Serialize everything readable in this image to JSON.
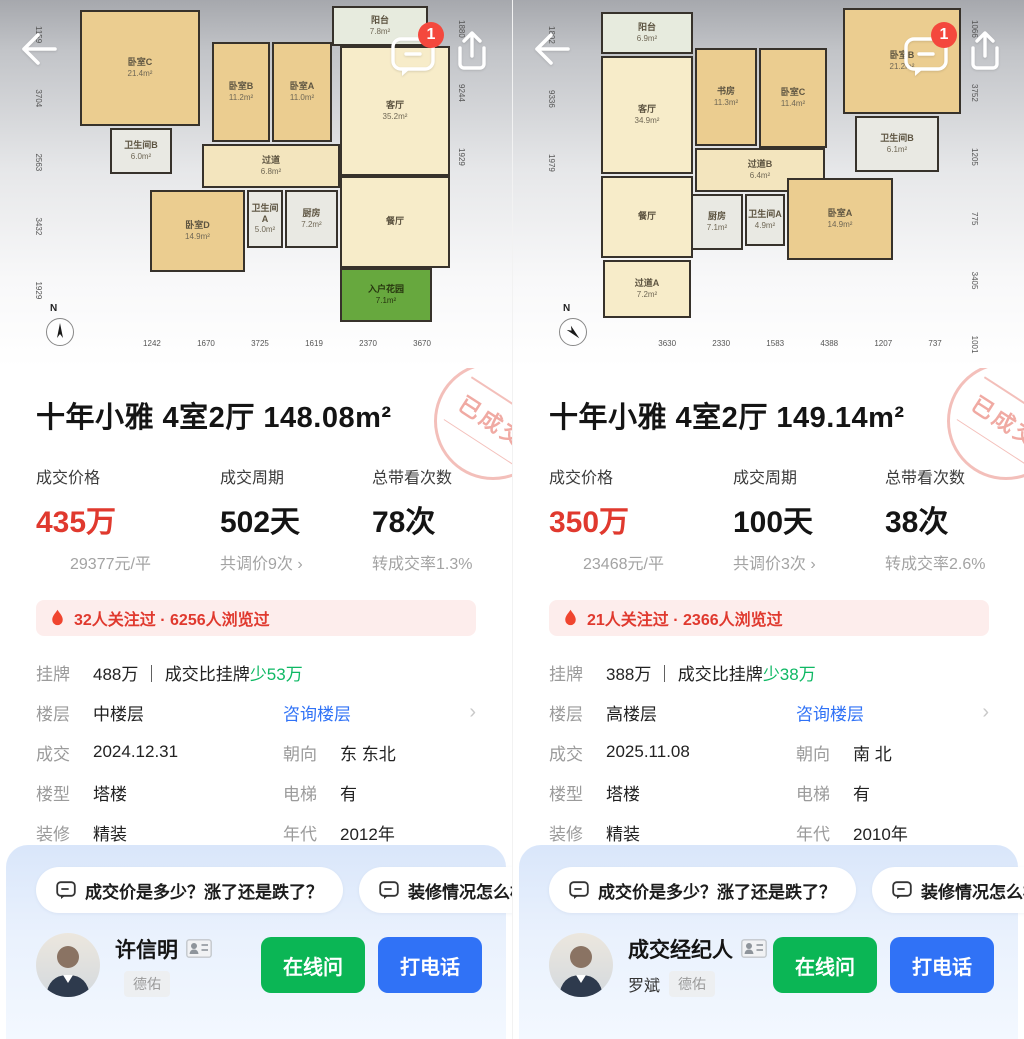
{
  "colors": {
    "accent_red": "#E0392E",
    "badge_red": "#F4483D",
    "link_blue": "#3072F6",
    "green_diff": "#0EB864",
    "btn_green": "#0BB655",
    "btn_blue": "#3072F6",
    "hot_bg": "#FDEDEC",
    "stamp": "#EE9C94",
    "stamp_ring": "#F2B5AF"
  },
  "panels": [
    {
      "header": {
        "badge_count": "1"
      },
      "floorplan": {
        "rooms": [
          {
            "name": "卧室C",
            "area": "21.4m²"
          },
          {
            "name": "卧室B",
            "area": "11.2m²"
          },
          {
            "name": "卧室A",
            "area": "11.0m²"
          },
          {
            "name": "阳台",
            "area": "7.8m²"
          },
          {
            "name": "卫生间B",
            "area": "6.0m²"
          },
          {
            "name": "过道",
            "area": "6.8m²"
          },
          {
            "name": "客厅",
            "area": "35.2m²"
          },
          {
            "name": "卧室D",
            "area": "14.9m²"
          },
          {
            "name": "卫生间A",
            "area": "5.0m²"
          },
          {
            "name": "厨房",
            "area": "7.2m²"
          },
          {
            "name": "餐厅",
            "area": ""
          },
          {
            "name": "入户花园",
            "area": "7.1m²"
          }
        ],
        "dims_bottom": "1242 1670 3725 1619 2370 3670",
        "dims_left": "1159 3704 2563 3432 1929",
        "dims_right": "1880 9244 1929",
        "compass_label": "N"
      },
      "stamp": "已成交",
      "title": "十年小雅 4室2厅 148.08m²",
      "stats": [
        {
          "label": "成交价格",
          "value": "435万",
          "sub": "29377元/平"
        },
        {
          "label": "成交周期",
          "value": "502天",
          "sub": "共调价9次 ›"
        },
        {
          "label": "总带看次数",
          "value": "78次",
          "sub": "转成交率1.3%"
        }
      ],
      "hot_bar": "32人关注过 · 6256人浏览过",
      "info": {
        "listing": {
          "label": "挂牌",
          "value": "488万 ｜ 成交比挂牌",
          "diff": "少53万"
        },
        "floor": {
          "label": "楼层",
          "value": "中楼层",
          "link": "咨询楼层",
          "chevron": "›"
        },
        "rows": [
          {
            "l1": "成交",
            "v1": "2024.12.31",
            "l2": "朝向",
            "v2": "东 东北"
          },
          {
            "l1": "楼型",
            "v1": "塔楼",
            "l2": "电梯",
            "v2": "有"
          },
          {
            "l1": "装修",
            "v1": "精装",
            "l2": "年代",
            "v2": "2012年"
          },
          {
            "l1": "用途",
            "v1": "普通住宅",
            "l2": "权属",
            "v2": "商品房"
          }
        ]
      },
      "chips": [
        "成交价是多少？涨了还是跌了？",
        "装修情况怎么样?"
      ],
      "agent": {
        "name": "许信明",
        "sub_name": "",
        "company": "德佑",
        "ask_label": "在线问",
        "call_label": "打电话"
      }
    },
    {
      "header": {
        "badge_count": "1"
      },
      "floorplan": {
        "rooms": [
          {
            "name": "阳台",
            "area": "6.9m²"
          },
          {
            "name": "客厅",
            "area": "34.9m²"
          },
          {
            "name": "书房",
            "area": "11.3m²"
          },
          {
            "name": "卧室C",
            "area": "11.4m²"
          },
          {
            "name": "卧室B",
            "area": "21.2m²"
          },
          {
            "name": "卫生间B",
            "area": "6.1m²"
          },
          {
            "name": "过道B",
            "area": "6.4m²"
          },
          {
            "name": "餐厅",
            "area": ""
          },
          {
            "name": "厨房",
            "area": "7.1m²"
          },
          {
            "name": "卫生间A",
            "area": "4.9m²"
          },
          {
            "name": "卧室A",
            "area": "14.9m²"
          },
          {
            "name": "过道A",
            "area": "7.2m²"
          }
        ],
        "dims_bottom": "3630 2330 1583 4388 1207 737",
        "dims_left": "1802 9336 1979",
        "dims_right": "1066 3752 1205 775 3405 1001 1979",
        "compass_label": "N"
      },
      "stamp": "已成交",
      "title": "十年小雅 4室2厅 149.14m²",
      "stats": [
        {
          "label": "成交价格",
          "value": "350万",
          "sub": "23468元/平"
        },
        {
          "label": "成交周期",
          "value": "100天",
          "sub": "共调价3次 ›"
        },
        {
          "label": "总带看次数",
          "value": "38次",
          "sub": "转成交率2.6%"
        }
      ],
      "hot_bar": "21人关注过 · 2366人浏览过",
      "info": {
        "listing": {
          "label": "挂牌",
          "value": "388万 ｜ 成交比挂牌",
          "diff": "少38万"
        },
        "floor": {
          "label": "楼层",
          "value": "高楼层",
          "link": "咨询楼层",
          "chevron": "›"
        },
        "rows": [
          {
            "l1": "成交",
            "v1": "2025.11.08",
            "l2": "朝向",
            "v2": "南 北"
          },
          {
            "l1": "楼型",
            "v1": "塔楼",
            "l2": "电梯",
            "v2": "有"
          },
          {
            "l1": "装修",
            "v1": "精装",
            "l2": "年代",
            "v2": "2010年"
          },
          {
            "l1": "用途",
            "v1": "普通住宅",
            "l2": "权属",
            "v2": "商品房"
          }
        ]
      },
      "chips": [
        "成交价是多少？涨了还是跌了？",
        "装修情况怎么样?"
      ],
      "agent": {
        "name": "成交经纪人",
        "sub_name": "罗斌",
        "company": "德佑",
        "ask_label": "在线问",
        "call_label": "打电话"
      }
    }
  ]
}
